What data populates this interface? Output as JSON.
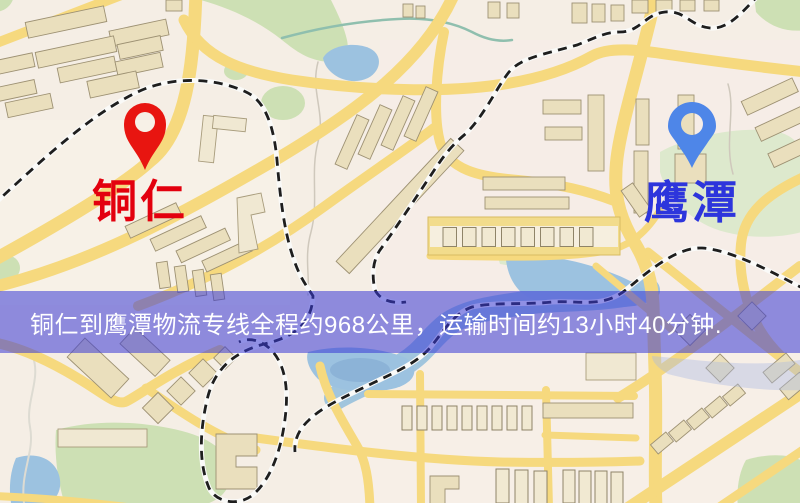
{
  "markers": {
    "origin": {
      "label": "铜仁"
    },
    "destination": {
      "label": "鹰潭"
    }
  },
  "banner": {
    "text": "铜仁到鹰潭物流专线全程约968公里，运输时间约13小时40分钟.",
    "distance": "968公里",
    "duration": "13小时40分钟"
  },
  "theme": {
    "--bg": "#f5eee5",
    "--road": "#f6d97e",
    "--building": "#eadfbd",
    "--bstroke": "#9d9173",
    "--green": "#cde0b4",
    "--green2": "#dde9cd",
    "--water": "#9cc2e0",
    "--rail": "#1e1e1e",
    "--origin-pin": "#e81510",
    "--origin-label": "#e3000e",
    "--dest-pin": "#4e86e8",
    "--dest-label": "#2d35dc",
    "--banner-bg": "rgba(56,56,214,0.55)",
    "--banner-text": "#ffffff"
  }
}
